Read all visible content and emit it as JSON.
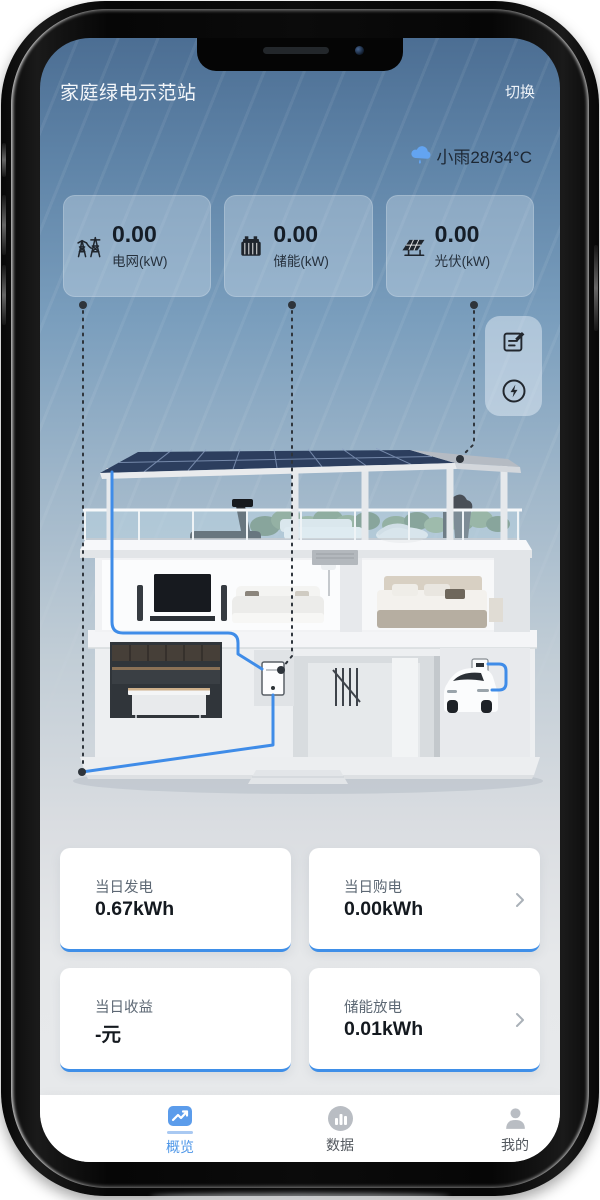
{
  "app": {
    "header": {
      "title": "家庭绿电示范站",
      "switch_label": "切换"
    },
    "weather": {
      "condition": "小雨",
      "temps": "28/34°C",
      "display": "小雨28/34°C"
    },
    "stats": [
      {
        "id": "grid",
        "value": "0.00",
        "label": "电网(kW)",
        "icon": "power-tower-icon"
      },
      {
        "id": "storage",
        "value": "0.00",
        "label": "储能(kW)",
        "icon": "battery-icon"
      },
      {
        "id": "pv",
        "value": "0.00",
        "label": "光伏(kW)",
        "icon": "solar-panel-icon"
      }
    ],
    "quick_actions": [
      {
        "id": "report",
        "icon": "edit-note-icon"
      },
      {
        "id": "energy-flow",
        "icon": "energy-flash-icon"
      }
    ],
    "summary_cards": [
      {
        "label": "当日发电",
        "value": "0.67kWh",
        "has_chevron": false
      },
      {
        "label": "当日购电",
        "value": "0.00kWh",
        "has_chevron": true
      },
      {
        "label": "当日收益",
        "value": "-元",
        "has_chevron": false
      },
      {
        "label": "储能放电",
        "value": "0.01kWh",
        "has_chevron": true
      }
    ],
    "tabbar": [
      {
        "label": "概览",
        "active": true,
        "icon": "overview-chart-icon"
      },
      {
        "label": "数据",
        "active": false,
        "icon": "data-bars-icon"
      },
      {
        "label": "我的",
        "active": false,
        "icon": "profile-icon"
      }
    ],
    "colors": {
      "accent_blue": "#3f8ce8",
      "nav_active_blue": "#5b9ceb",
      "sky_top": "#4c6e93",
      "solar_panel_navy": "#2c3e5e",
      "card_bottom_border": "#3f8fe8"
    }
  }
}
